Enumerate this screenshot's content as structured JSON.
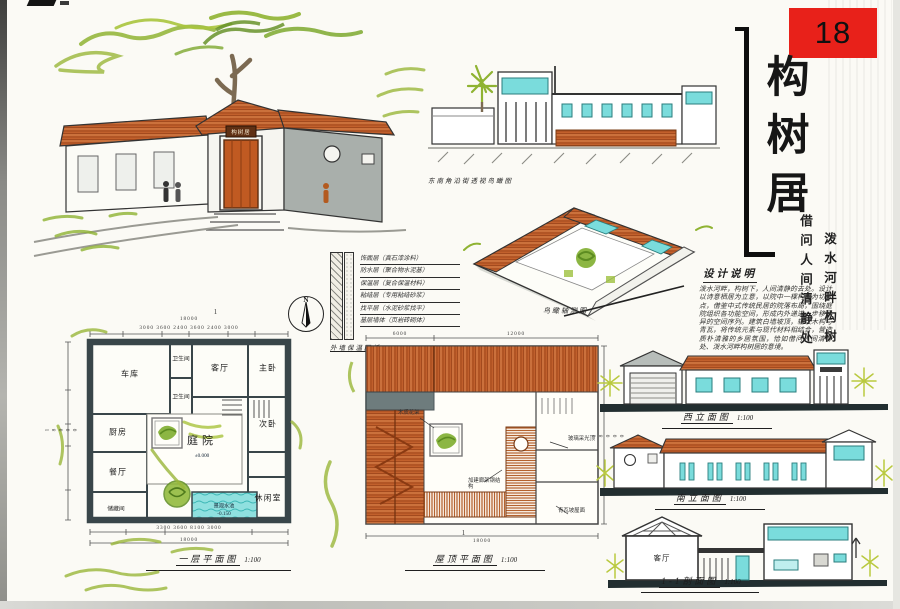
{
  "page": {
    "tag_number": "18"
  },
  "title_block": {
    "title": "构树居",
    "subtitle_col1": "借问人间清静处",
    "subtitle_col2": "泼水河畔构树居"
  },
  "design_notes": {
    "heading": "设计说明",
    "body": "泼水河畔，构树下，人间清静的去处。设计以诗意栖居为立意，以院中一棵构树为切入点，借鉴中式传统民居的院落布局，围绕庭院组织各功能空间，形成内外递进、步移景异的空间序列。建筑白墙坡顶，辅以木构与青瓦，将传统元素与现代材料相结合，营造质朴清雅的乡居氛围，恰如借问人间清静处、泼水河畔构树居的意境。"
  },
  "perspectives": {
    "main": {
      "plaque": "构树居"
    },
    "street": {
      "caption": "东南角沿街透视鸟瞰图"
    },
    "aerial": {
      "caption": "鸟瞰轴测图"
    }
  },
  "wall_detail": {
    "caption": "外墙保温图纸",
    "scale": "1:20",
    "layers": [
      "饰面层（真石漆涂料）",
      "防水层（聚合物水泥基）",
      "保温层（复合保温材料）",
      "粘结层（专用粘结砂浆）",
      "找平层（水泥砂浆找平）",
      "基层墙体（页岩砖砌体）"
    ]
  },
  "compass": {
    "label": "N"
  },
  "floor_plan": {
    "caption": "一层平面图",
    "scale": "1:100",
    "rooms": {
      "garage": "车库",
      "bath1": "卫生间",
      "living": "客厅",
      "master": "主卧",
      "bath2": "卫生间",
      "kitchen": "厨房",
      "dining": "餐厅",
      "courtyard": "庭院",
      "second": "次卧",
      "leisure": "休闲室",
      "storage": "储藏间",
      "pool": "景观水池"
    },
    "levels": {
      "courtyard": "±0.000",
      "pool": "-0.150"
    },
    "dims": {
      "top_total": "18000",
      "top_segs": "3000  3600  2400  3600  2400  3000",
      "left_total": "18000",
      "bottom_segs": "3300  3600  8100  3000",
      "bottom_total": "18000"
    },
    "section_marker": "1"
  },
  "roof_plan": {
    "caption": "屋顶平面图",
    "scale": "1:100",
    "notes": {
      "pergola": "木质花架",
      "skylight": "玻璃采光顶",
      "steel": "加建廊架钢结构",
      "tile": "青瓦坡屋面"
    },
    "dims": {
      "top_left": "6000",
      "top_right": "12000",
      "right_total": "18000",
      "bottom_total": "18000"
    }
  },
  "elevations": {
    "west": {
      "caption": "西立面图",
      "scale": "1:100"
    },
    "south": {
      "caption": "南立面图",
      "scale": "1:100"
    },
    "section": {
      "caption": "1-1剖面图",
      "scale": "1:100",
      "room": "客厅"
    }
  },
  "colors": {
    "accent_red": "#e8211a",
    "roof_orange": "#c2602c",
    "water_cyan": "#7adcdc",
    "leaf_green": "#8fb332",
    "ink": "#1c1c1c",
    "plan_wall": "#39464a"
  }
}
